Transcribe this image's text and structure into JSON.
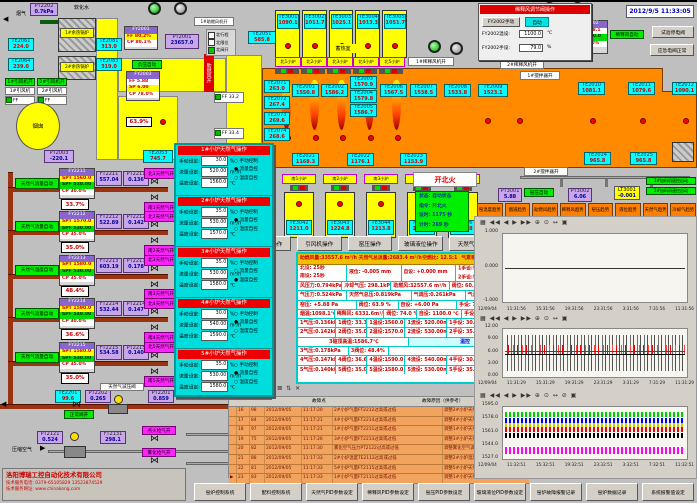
{
  "meta": {
    "datetime": "2012/9/5 11:33:05"
  },
  "top_left": {
    "smoke": "烟气",
    "pt2202t": {
      "id": "PT2202",
      "v": "0.7kPa"
    },
    "soft_water": "软化水",
    "boiler1": "1#余热锅炉",
    "boiler2": "2#余热锅炉",
    "te2061": {
      "id": "TE2061",
      "v": "224.0"
    },
    "te2064": {
      "id": "TE2064",
      "v": "239.0"
    },
    "te2081": {
      "id": "TE2081",
      "v": "313.0"
    },
    "te2083": {
      "id": "TE2083",
      "v": "319.0"
    },
    "fan1_on": "1#引风机开",
    "fan2_on": "2#引风机开",
    "fan1": "1#引风机",
    "fan2": "2#引风机",
    "ff1": "FF 50.0Hz",
    "ff2": "FF 50.0Hz",
    "chimney": "烟囱",
    "pt2003": {
      "id": "PT2003",
      "v": "-220.1"
    },
    "te2053": {
      "id": "TE2053",
      "v": "745.7"
    },
    "fy2001": {
      "hd": "FY2001",
      "ff": "FF 80.2%",
      "cp": "CP 80.1%"
    },
    "pt2001": {
      "id": "PT2001",
      "v": "23657.0"
    },
    "vac_auto": "负压自动",
    "fy2003": {
      "hd": "FY2003",
      "ff": "FF 5.88",
      "sp": "SP 6.00",
      "cp": "CP 78.0%"
    },
    "damper": "63.9%",
    "comb_air_open": "助燃风开",
    "comb_fan_on": "1#助燃风机开",
    "te2051": {
      "id": "TE2051",
      "v": "585.8"
    },
    "checks": [
      "北行程",
      "北限位",
      "北阀开"
    ],
    "ff_aux1": "FF 33.2",
    "ff_aux2": "FF 33.4"
  },
  "north": {
    "regen_label": "蓄热室",
    "chambers": [
      {
        "id": "TE3001",
        "v": "1090.1"
      },
      {
        "id": "TE3002",
        "v": "1011.7"
      },
      {
        "id": "TE3003",
        "v": "1025.1"
      },
      {
        "id": "TE3004",
        "v": "1013.3"
      },
      {
        "id": "TE3005",
        "v": "1051.7"
      }
    ],
    "ports": [
      {
        "label": "北1小炉"
      },
      {
        "label": "北2小炉"
      },
      {
        "label": "北3小炉"
      },
      {
        "label": "北4小炉"
      },
      {
        "label": "北5小炉"
      }
    ],
    "crown": [
      {
        "id": "TE2001",
        "v": "1550.8"
      },
      {
        "id": "TE2002",
        "v": "1586.2"
      },
      {
        "id": "TE2003",
        "v": "1570.9"
      },
      {
        "id": "TE2004",
        "v": "1579.8"
      },
      {
        "id": "TE2005",
        "v": "1586.7"
      },
      {
        "id": "TE2006",
        "v": "1567.5"
      },
      {
        "id": "TE2007",
        "v": "1538.5"
      },
      {
        "id": "TE2008",
        "v": "1533.8"
      },
      {
        "id": "TE2009",
        "v": "1523.1"
      }
    ],
    "left_col": [
      {
        "id": "TE2071",
        "v": "263.0"
      },
      {
        "id": "TE2072",
        "v": "267.4"
      },
      {
        "id": "TE2073",
        "v": "269.6"
      },
      {
        "id": "TE2074",
        "v": "268.6"
      }
    ],
    "bottom": [
      {
        "id": "TE2021",
        "v": "1168.3"
      },
      {
        "id": "TE2022",
        "v": "1176.1"
      },
      {
        "id": "TE2023",
        "v": "1153.9"
      },
      {
        "id": "TE2024",
        "v": "965.8"
      },
      {
        "id": "TE2025",
        "v": "965.8"
      }
    ],
    "right_col": [
      {
        "id": "TE2010",
        "v": "1081.1"
      },
      {
        "id": "TE2011",
        "v": "1079.6"
      },
      {
        "id": "TE2012",
        "v": "1090.1"
      }
    ]
  },
  "south": {
    "groups": [
      {
        "label": "南1小炉",
        "id": "TE3042",
        "v": "1211.0"
      },
      {
        "label": "南2小炉",
        "id": "TE3043",
        "v": "1224.8"
      },
      {
        "label": "南3小炉",
        "id": "TE3044",
        "v": "1213.8"
      },
      {
        "label": "南4小炉",
        "id": "TE3045",
        "v": "1281.8"
      },
      {
        "label": "南5小炉",
        "id": "TE3046",
        "v": "1251.8"
      }
    ]
  },
  "fire": {
    "button": "开北火",
    "status": [
      "状态:  自动状态",
      "指令:  开北火",
      "设时:  1175 秒",
      "计时:  269 秒"
    ]
  },
  "op_buttons": [
    {
      "label": "稀释风操作"
    },
    {
      "label": "引风机操作"
    },
    {
      "label": "窑压操作"
    },
    {
      "label": "玻璃液位操作"
    },
    {
      "label": "天然气操作"
    }
  ],
  "right_mid": {
    "pt3001": {
      "id": "PT3001",
      "v": "5.88"
    },
    "kiln_auto": "窑压自动",
    "pt3002": {
      "id": "PT3002",
      "v": "6.06"
    },
    "lt3001": {
      "id": "LT3001",
      "v": "-0.001"
    },
    "feeder1": "1#加料机速控自动",
    "feeder2": "2#加料机速控自动",
    "stir1": "1#搅拌器开",
    "stir2": "2#搅拌器开",
    "dilfan1": "1#稀释风机开",
    "dilfan2": "2#稀释风机开"
  },
  "trend_buttons": [
    {
      "label": "窑温度趋势"
    },
    {
      "label": "烟道趋势"
    },
    {
      "label": "助燃风趋势"
    },
    {
      "label": "稀释风趋势"
    },
    {
      "label": "窑压趋势"
    },
    {
      "label": "液位趋势"
    },
    {
      "label": "天然气趋势"
    },
    {
      "label": "冷却气趋势"
    }
  ],
  "right_top": {
    "popup_title": "稀释风调节阀操作",
    "btn_manual": "FY2002手动",
    "btn_auto": "自动",
    "f_temp": "FY2002温设:",
    "temp_v": "1100.0",
    "u_c": "℃",
    "f_hand": "FY2002手设:",
    "hand_v": "79.0",
    "u_pct": "%",
    "pct": "74.0%",
    "ft2002": {
      "id": "FT2002",
      "v": "6331.6"
    },
    "fy2002": {
      "hd": "FY2002",
      "ff": "FF 1098.1",
      "sp": "SP 1100.0",
      "cp": "CP 79.0%"
    },
    "dil_auto": "稀释风自动",
    "btn_test": "试验停电阀",
    "btn_emerg": "应急电阀正常"
  },
  "gas_trains": {
    "rows": [
      {
        "auto": "天然气流量自动",
        "hd": "FY2211",
        "spt": "SPT 1560.0",
        "spf": "SPF 520.00",
        "cp": "CP 30.0%",
        "pct": "33.7%",
        "ft_id": "FT2211",
        "ft": "557.04",
        "pt_id": "PT2211",
        "pt": "0.136",
        "v1": "北1天然气开",
        "v2": "南1天然气开"
      },
      {
        "auto": "天然气流量自动",
        "hd": "FY2212",
        "spt": "SPT 1570.0",
        "spf": "SPF 530.00",
        "cp": "CP 35.0%",
        "pct": "35.0%",
        "ft_id": "FT2212",
        "ft": "522.89",
        "pt_id": "PT2212",
        "pt": "0.142",
        "v1": "北2天然气开",
        "v2": "南2天然气开"
      },
      {
        "auto": "天然气温度自动",
        "hd": "FY2213",
        "spt": "SPT 1580.0",
        "spf": "SPF 530.00",
        "cp": "CP 35.0%",
        "pct": "48.4%",
        "ft_id": "FT2213",
        "ft": "603.19",
        "pt_id": "PT2213",
        "pt": "0.178",
        "v1": "北3天然气开",
        "v2": "南3天然气开"
      },
      {
        "auto": "天然气流量自动",
        "hd": "FY2214",
        "spt": "SPT 1590.0",
        "spf": "SPF 540.00",
        "cp": "CP 30.0%",
        "pct": "36.6%",
        "ft_id": "FT2214",
        "ft": "532.44",
        "pt_id": "PT2214",
        "pt": "0.147",
        "v1": "北4天然气开",
        "v2": "南4天然气开"
      },
      {
        "auto": "天然气流量自动",
        "hd": "FY2215",
        "spt": "SPT 1580.0",
        "spf": "SPF 530.00",
        "cp": "CP 35.0%",
        "pct": "35.0%",
        "ft_id": "FT2215",
        "ft": "534.58",
        "pt_id": "PT2215",
        "pt": "0.140",
        "v1": "北5天然气开",
        "v2": "南5天然气开"
      }
    ]
  },
  "gas_main": {
    "te2201": {
      "id": "TE2201",
      "v": "99.6"
    },
    "pt2202": {
      "id": "PT2202",
      "v": "0.265"
    },
    "valve_ok": "正常阀开",
    "reducer": "天然气减压阀",
    "pt2201": {
      "id": "PT2201",
      "v": "0.859"
    }
  },
  "air_line": {
    "label": "压缩空气",
    "pt2121": {
      "id": "PT2121",
      "v": "0.524"
    },
    "ft2131": {
      "id": "FT2131",
      "v": "298.1"
    },
    "v1": "点火枪气开",
    "v2": "雾化枪气开"
  },
  "popup": {
    "f_manual": "手动设定:",
    "f_flow": "流量设定:",
    "f_temp": "温度设定:",
    "u_pct": "%",
    "u_flow": "m³/h",
    "u_temp": "℃",
    "r_manual": "手动控制",
    "r_flow": "流量自控",
    "r_temp": "温度自控",
    "sections": [
      {
        "title": "1#小炉天然气操作",
        "manual": "30.0",
        "flow": "520.00",
        "temp": "1560.0",
        "r1": "○",
        "r2": "●",
        "r3": "○"
      },
      {
        "title": "2#小炉天然气操作",
        "manual": "35.0",
        "flow": "530.00",
        "temp": "1570.0",
        "r1": "○",
        "r2": "●",
        "r3": "○"
      },
      {
        "title": "3#小炉天然气操作",
        "manual": "35.0",
        "flow": "530.00",
        "temp": "1580.0",
        "r1": "○",
        "r2": "○",
        "r3": "●"
      },
      {
        "title": "4#小炉天然气操作",
        "manual": "30.0",
        "flow": "540.00",
        "temp": "1590.0",
        "r1": "○",
        "r2": "●",
        "r3": "○"
      },
      {
        "title": "5#小炉天然气操作",
        "manual": "35.0",
        "flow": "530.00",
        "temp": "1580.0",
        "r1": "○",
        "r2": "●",
        "r3": "○"
      }
    ]
  },
  "data_panel": {
    "header": [
      "助燃风量:33557.6 m³/h",
      "天然气总流量:2683.4 m³/h",
      "空燃比: 12.5:1",
      "气累积量: 134057.7m³"
    ],
    "rowA": {
      "c1": "北设:  25秒",
      "c2": "南设:  25秒",
      "c3": "液位:  -0.005 mm",
      "c4": "自设:  +0.000 mm",
      "c5": "1手设:50.0Hz",
      "c5b": "自动",
      "c6": "2手设:50.0Hz",
      "c6b": "自动"
    },
    "rows": {
      "b": [
        "风压力:0.794kPa",
        "冷却气压: 298.1kPa",
        "助燃风:32557.6 m³/h",
        "阀位: 60.2%",
        "设定: 60.0%"
      ],
      "c": [
        "气压力:0.524kPa",
        "天然气总压:0.819kPa",
        "气调压:0.261kPa",
        "气温度: 19.6℃"
      ],
      "d": [
        "窑压: +5.88 Pa",
        "阀位: 63.9 %",
        "自设: +6.00 Pa",
        "手设: 70.0%",
        "自动"
      ],
      "e": [
        "烟温:1098.1℃",
        "稀释风: 6331.6m³/h",
        "阀位: 74.0 %",
        "自设: 1100.0 ℃",
        "手设: 79.0%",
        "自动"
      ],
      "r1": [
        "1气压:0.136kPa",
        "1阀位: 33.3%",
        "1温设:1560.0 ℃",
        "1流设: 520.00m³/h",
        "1手设: 30.0%",
        "流控"
      ],
      "r2": [
        "2气压:0.142kPa",
        "2阀位: 35.0%",
        "2温设:1570.0 ℃",
        "2流设: 530.00m³/h",
        "2手设: 35.0%",
        "流控"
      ],
      "r3a": [
        "3碹顶高温:1586.7℃",
        "温控"
      ],
      "r3b": [
        "3气压:0.178kPa",
        "3阀位: 48.4%"
      ],
      "r4": [
        "4气压:0.147kPa",
        "4阀位: 36.6%",
        "4温设:1590.0 ℃",
        "4流设: 540.00m³/h",
        "4手设: 30.0%",
        "流控"
      ],
      "r5": [
        "5气压:0.140kPa",
        "5阀位: 35.0%",
        "5温设:1580.0 ℃",
        "5流设: 530.00m³/h",
        "5手设: 35.0%",
        "流控"
      ]
    },
    "toolbar_icons": "▦ ▤ ▥ ▧ ⊞ ⊠ ⇅ ✕"
  },
  "alarm": {
    "toolbar_icons": "▦ ▤ ▥ ▧ ⊞ ⊠ ⇅ ✕",
    "col_fault": "故障点",
    "col_reason": "故障原因（供参考）",
    "rows": [
      {
        "m": "",
        "n": "16",
        "c": "98",
        "d": "2012/09/05",
        "t": "11:17:20",
        "f": "2#小炉气量FT2212过高或过低",
        "r": "调整2#小炉天然气调节阀或减压阀"
      },
      {
        "m": "",
        "n": "17",
        "c": "84",
        "d": "2012/09/05",
        "t": "11:17:21",
        "f": "4#小炉气量FT2214过高或过低",
        "r": "调整4#小炉天然气调节阀或减压阀"
      },
      {
        "m": "",
        "n": "18",
        "c": "97",
        "d": "2012/09/05",
        "t": "11:17:21",
        "f": "1#小炉气量FT2211过高或过低",
        "r": "调整1#小炉天然气调节阀或减压阀"
      },
      {
        "m": "",
        "n": "19",
        "c": "75",
        "d": "2012/09/05",
        "t": "11:17:26",
        "f": "3#小炉气量FT2213过高或过低",
        "r": "调整3#小炉天然气调节阀或减压阀"
      },
      {
        "m": "",
        "n": "20",
        "c": "82",
        "d": "2012/09/05",
        "t": "11:17:30",
        "f": "雾化空气压力PT2122过高或过低",
        "r": "调整雾化空气调节阀或减压阀"
      },
      {
        "m": "",
        "n": "21",
        "c": "88",
        "d": "2012/09/05",
        "t": "11:17:33",
        "f": "2#小炉温度TE2112过高或过低",
        "r": "调整2#小炉温度自控或自动阀"
      },
      {
        "m": "",
        "n": "22",
        "c": "81",
        "d": "2012/09/05",
        "t": "11:17:33",
        "f": "5#小炉气量FT2115过高或过低",
        "r": "调整5#小炉天然气调节阀或减压阀"
      },
      {
        "m": "▶",
        "n": "23",
        "c": "83",
        "d": "2012/09/05",
        "t": "11:17:33",
        "f": "1#小炉气量FT2111过高或过低",
        "r": "调整1#小炉天然气调节阀或减压阀"
      }
    ]
  },
  "charts": {
    "toolbar1": "▦  ◀◀ ◀ ▶ ▶▶  ⊕ ⊙ ↔  ▣",
    "toolbar2": "▦  ◀◀ ◀ ▶ ▶▶  ⊕ ⊙ ↔  ▣",
    "toolbar3": "▦  ◀◀ ◀ ▶ ▶▶  ⊕ ⊙ ↔ ⊘ ▣",
    "c1": {
      "yticks": [
        {
          "t": "1.000"
        },
        {
          "t": "0.000"
        },
        {
          "t": "-1.000"
        }
      ],
      "xticks": [
        {
          "t": "12/09/04"
        },
        {
          "t": "11:31:56"
        },
        {
          "t": "15:31:56"
        },
        {
          "t": "19:31:56"
        },
        {
          "t": "23:31:56"
        },
        {
          "t": "3:31:56"
        },
        {
          "t": "7:31:56"
        },
        {
          "t": "11:31:56"
        }
      ]
    },
    "c2": {
      "yticks": [
        {
          "t": "12.00"
        },
        {
          "t": "9.00"
        },
        {
          "t": "6.00"
        },
        {
          "t": "3.00"
        },
        {
          "t": "0.00"
        }
      ],
      "xticks": [
        {
          "t": "12/09/04"
        },
        {
          "t": "11:31:29"
        },
        {
          "t": "15:31:29"
        },
        {
          "t": "19:31:29"
        },
        {
          "t": "23:31:29"
        },
        {
          "t": "3:31:29"
        },
        {
          "t": "7:31:29"
        },
        {
          "t": "11:31:29"
        }
      ]
    },
    "c3": {
      "yticks": [
        {
          "t": "1595.0"
        },
        {
          "t": "1578.0"
        },
        {
          "t": "1561.0"
        },
        {
          "t": "1544.0"
        },
        {
          "t": "1527.0"
        }
      ],
      "xticks": [
        {
          "t": "12/09/04"
        },
        {
          "t": "11:32:51"
        },
        {
          "t": "15:32:51"
        },
        {
          "t": "19:32:51"
        },
        {
          "t": "23:32:51"
        },
        {
          "t": "3:32:51"
        },
        {
          "t": "7:32:51"
        },
        {
          "t": "11:32:51"
        }
      ]
    }
  },
  "chart_data": [
    {
      "type": "line",
      "title": "kiln pressure trend",
      "ylim": [
        -1,
        1
      ],
      "yticks": [
        1.0,
        0.0,
        -1.0
      ],
      "x_range": [
        "12/09/04 11:31:56",
        "12/09/05 11:31:56"
      ],
      "series": [
        {
          "name": "pressure",
          "approx_value": 0.0,
          "color": "#333333"
        }
      ]
    },
    {
      "type": "line",
      "title": "pressure noisy trend",
      "ylim": [
        0,
        12
      ],
      "yticks": [
        12,
        9,
        6,
        3,
        0
      ],
      "x_range": [
        "12/09/04 11:31:29",
        "12/09/05 11:31:29"
      ],
      "series": [
        {
          "name": "red",
          "approx_value": 6.3,
          "color": "#ff0000"
        },
        {
          "name": "black",
          "approx_value": 5.9,
          "color": "#000000"
        }
      ]
    },
    {
      "type": "line",
      "title": "furnace temperature trends",
      "ylim": [
        1527,
        1595
      ],
      "yticks": [
        1595,
        1578,
        1561,
        1544,
        1527
      ],
      "x_range": [
        "12/09/04 11:32:51",
        "12/09/05 11:32:51"
      ],
      "series": [
        {
          "name": "green",
          "approx_value": 1586,
          "color": "#00cc00"
        },
        {
          "name": "blue",
          "approx_value": 1578,
          "color": "#0000ff"
        },
        {
          "name": "yellow",
          "approx_value": 1572,
          "color": "#cccc00"
        },
        {
          "name": "red",
          "approx_value": 1568,
          "color": "#ff0000"
        },
        {
          "name": "black",
          "approx_value": 1561,
          "color": "#000000"
        },
        {
          "name": "magenta",
          "approx_value": 1540,
          "color": "#ff00ff"
        }
      ]
    }
  ],
  "bottom_buttons": [
    {
      "label": "窑炉控制系统"
    },
    {
      "label": "配料控制系统"
    },
    {
      "label": "天然气PID参数设定"
    },
    {
      "label": "稀释风PID参数设定"
    },
    {
      "label": "窑压PID参数设定"
    },
    {
      "label": "玻璃液位PID参数设定"
    },
    {
      "label": "窑炉故障报警记录"
    },
    {
      "label": "窑炉数据记录"
    },
    {
      "label": "系统报警值设定"
    }
  ],
  "company": {
    "name": "洛阳博瑞工控自动化技术有限公司",
    "tel": "技术服务电话: 0379-65105829  13523874529",
    "web": "技术服务网址: www.chinakong.com"
  }
}
